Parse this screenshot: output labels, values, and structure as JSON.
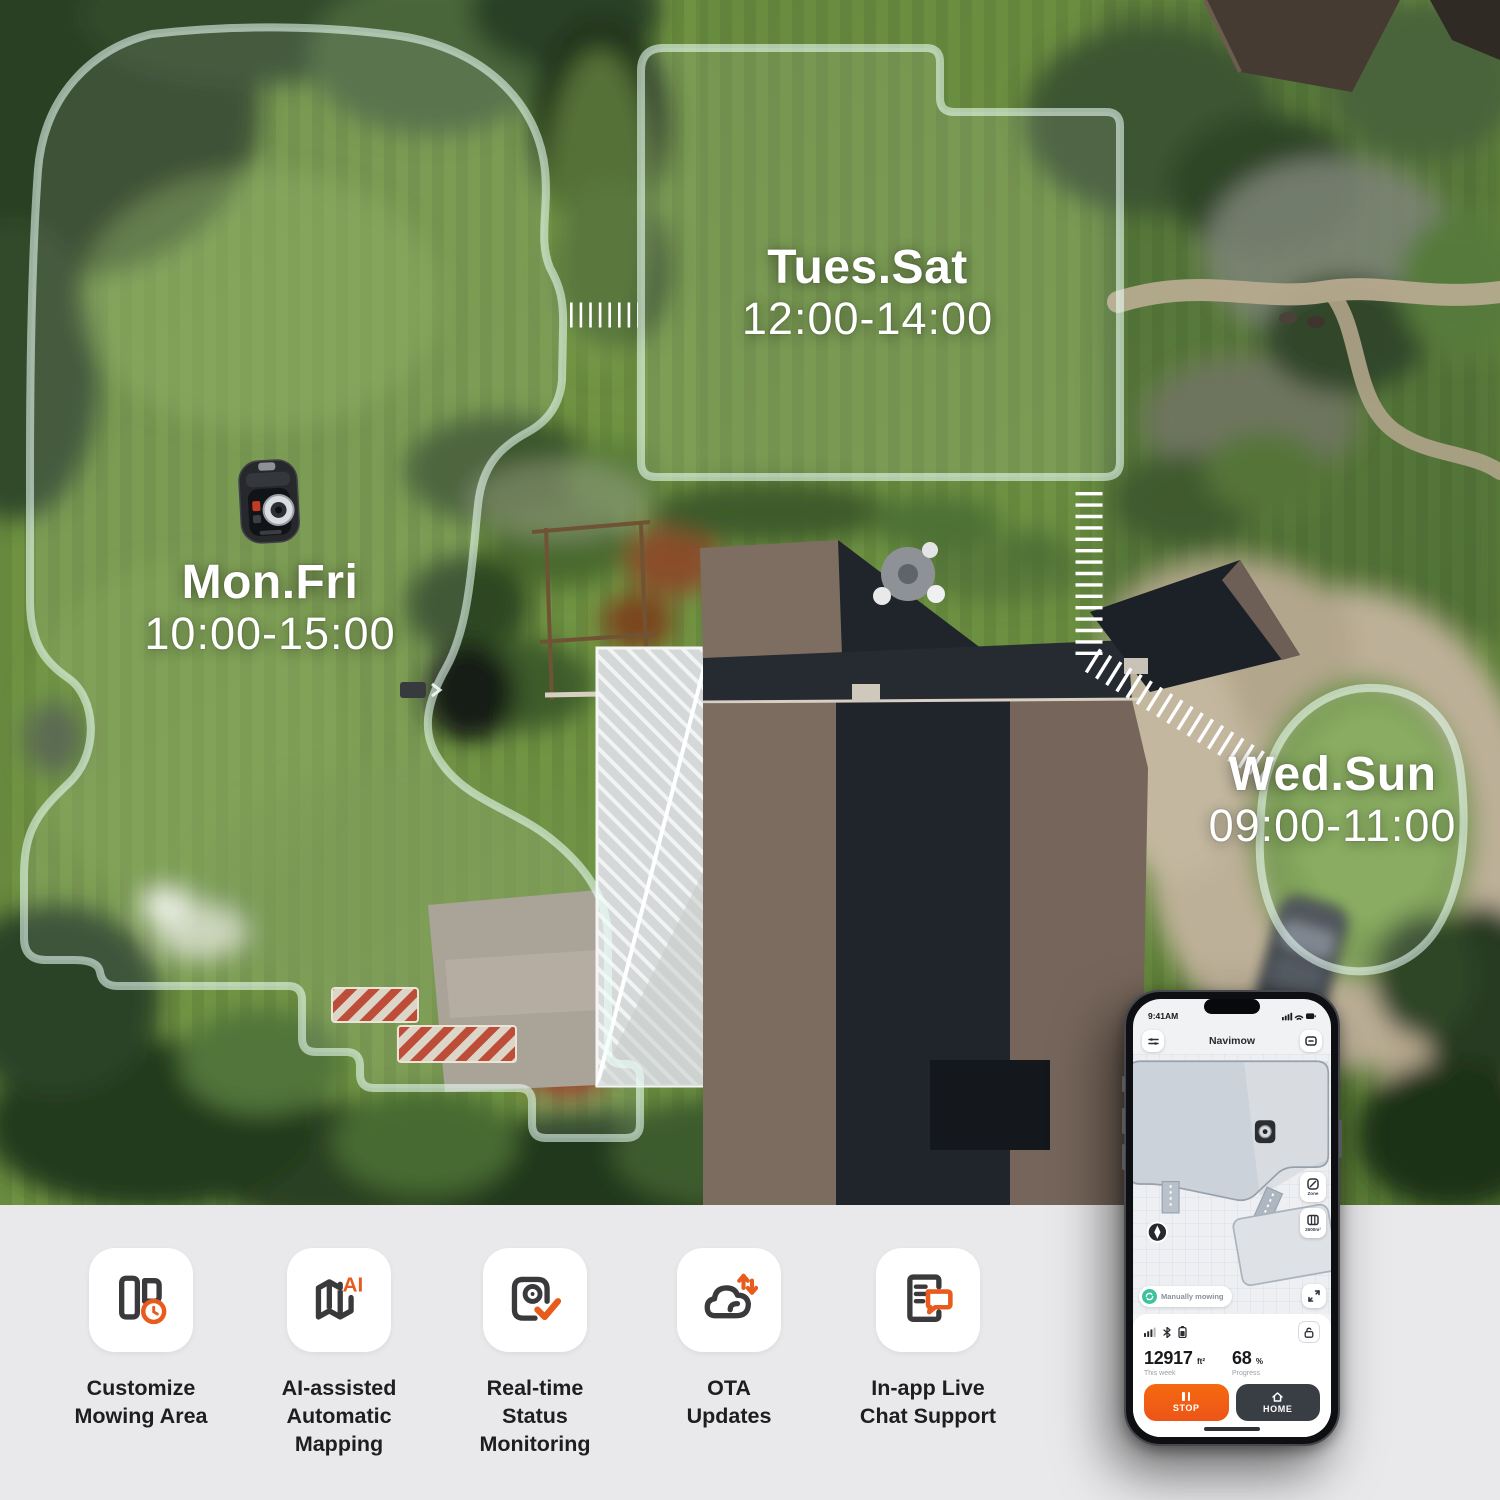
{
  "map_overlay": {
    "zones": [
      {
        "days": "Mon.Fri",
        "time": "10:00-15:00"
      },
      {
        "days": "Tues.Sat",
        "time": "12:00-14:00"
      },
      {
        "days": "Wed.Sun",
        "time": "09:00-11:00"
      }
    ]
  },
  "phone": {
    "status_time": "9:41AM",
    "title": "Navimow",
    "zone_button": "Zone",
    "zone_area": "2600m²",
    "status_pill": "Manually mowing",
    "stat_area": {
      "value": "12917",
      "unit": "ft²",
      "caption": "This week"
    },
    "stat_progress": {
      "value": "68",
      "unit": "%",
      "caption": "Progress"
    },
    "stop_button": "STOP",
    "home_button": "HOME"
  },
  "features": [
    {
      "label": "Customize\nMowing Area"
    },
    {
      "label": "AI-assisted\nAutomatic\nMapping"
    },
    {
      "label": "Real-time\nStatus\nMonitoring"
    },
    {
      "label": "OTA\nUpdates"
    },
    {
      "label": "In-app Live\nChat Support"
    }
  ],
  "colors": {
    "accent_orange": "#E85B1C",
    "dark_icon": "#3A3A3C",
    "zone_border": "#EAFFF6",
    "teal": "#3CC39C"
  }
}
